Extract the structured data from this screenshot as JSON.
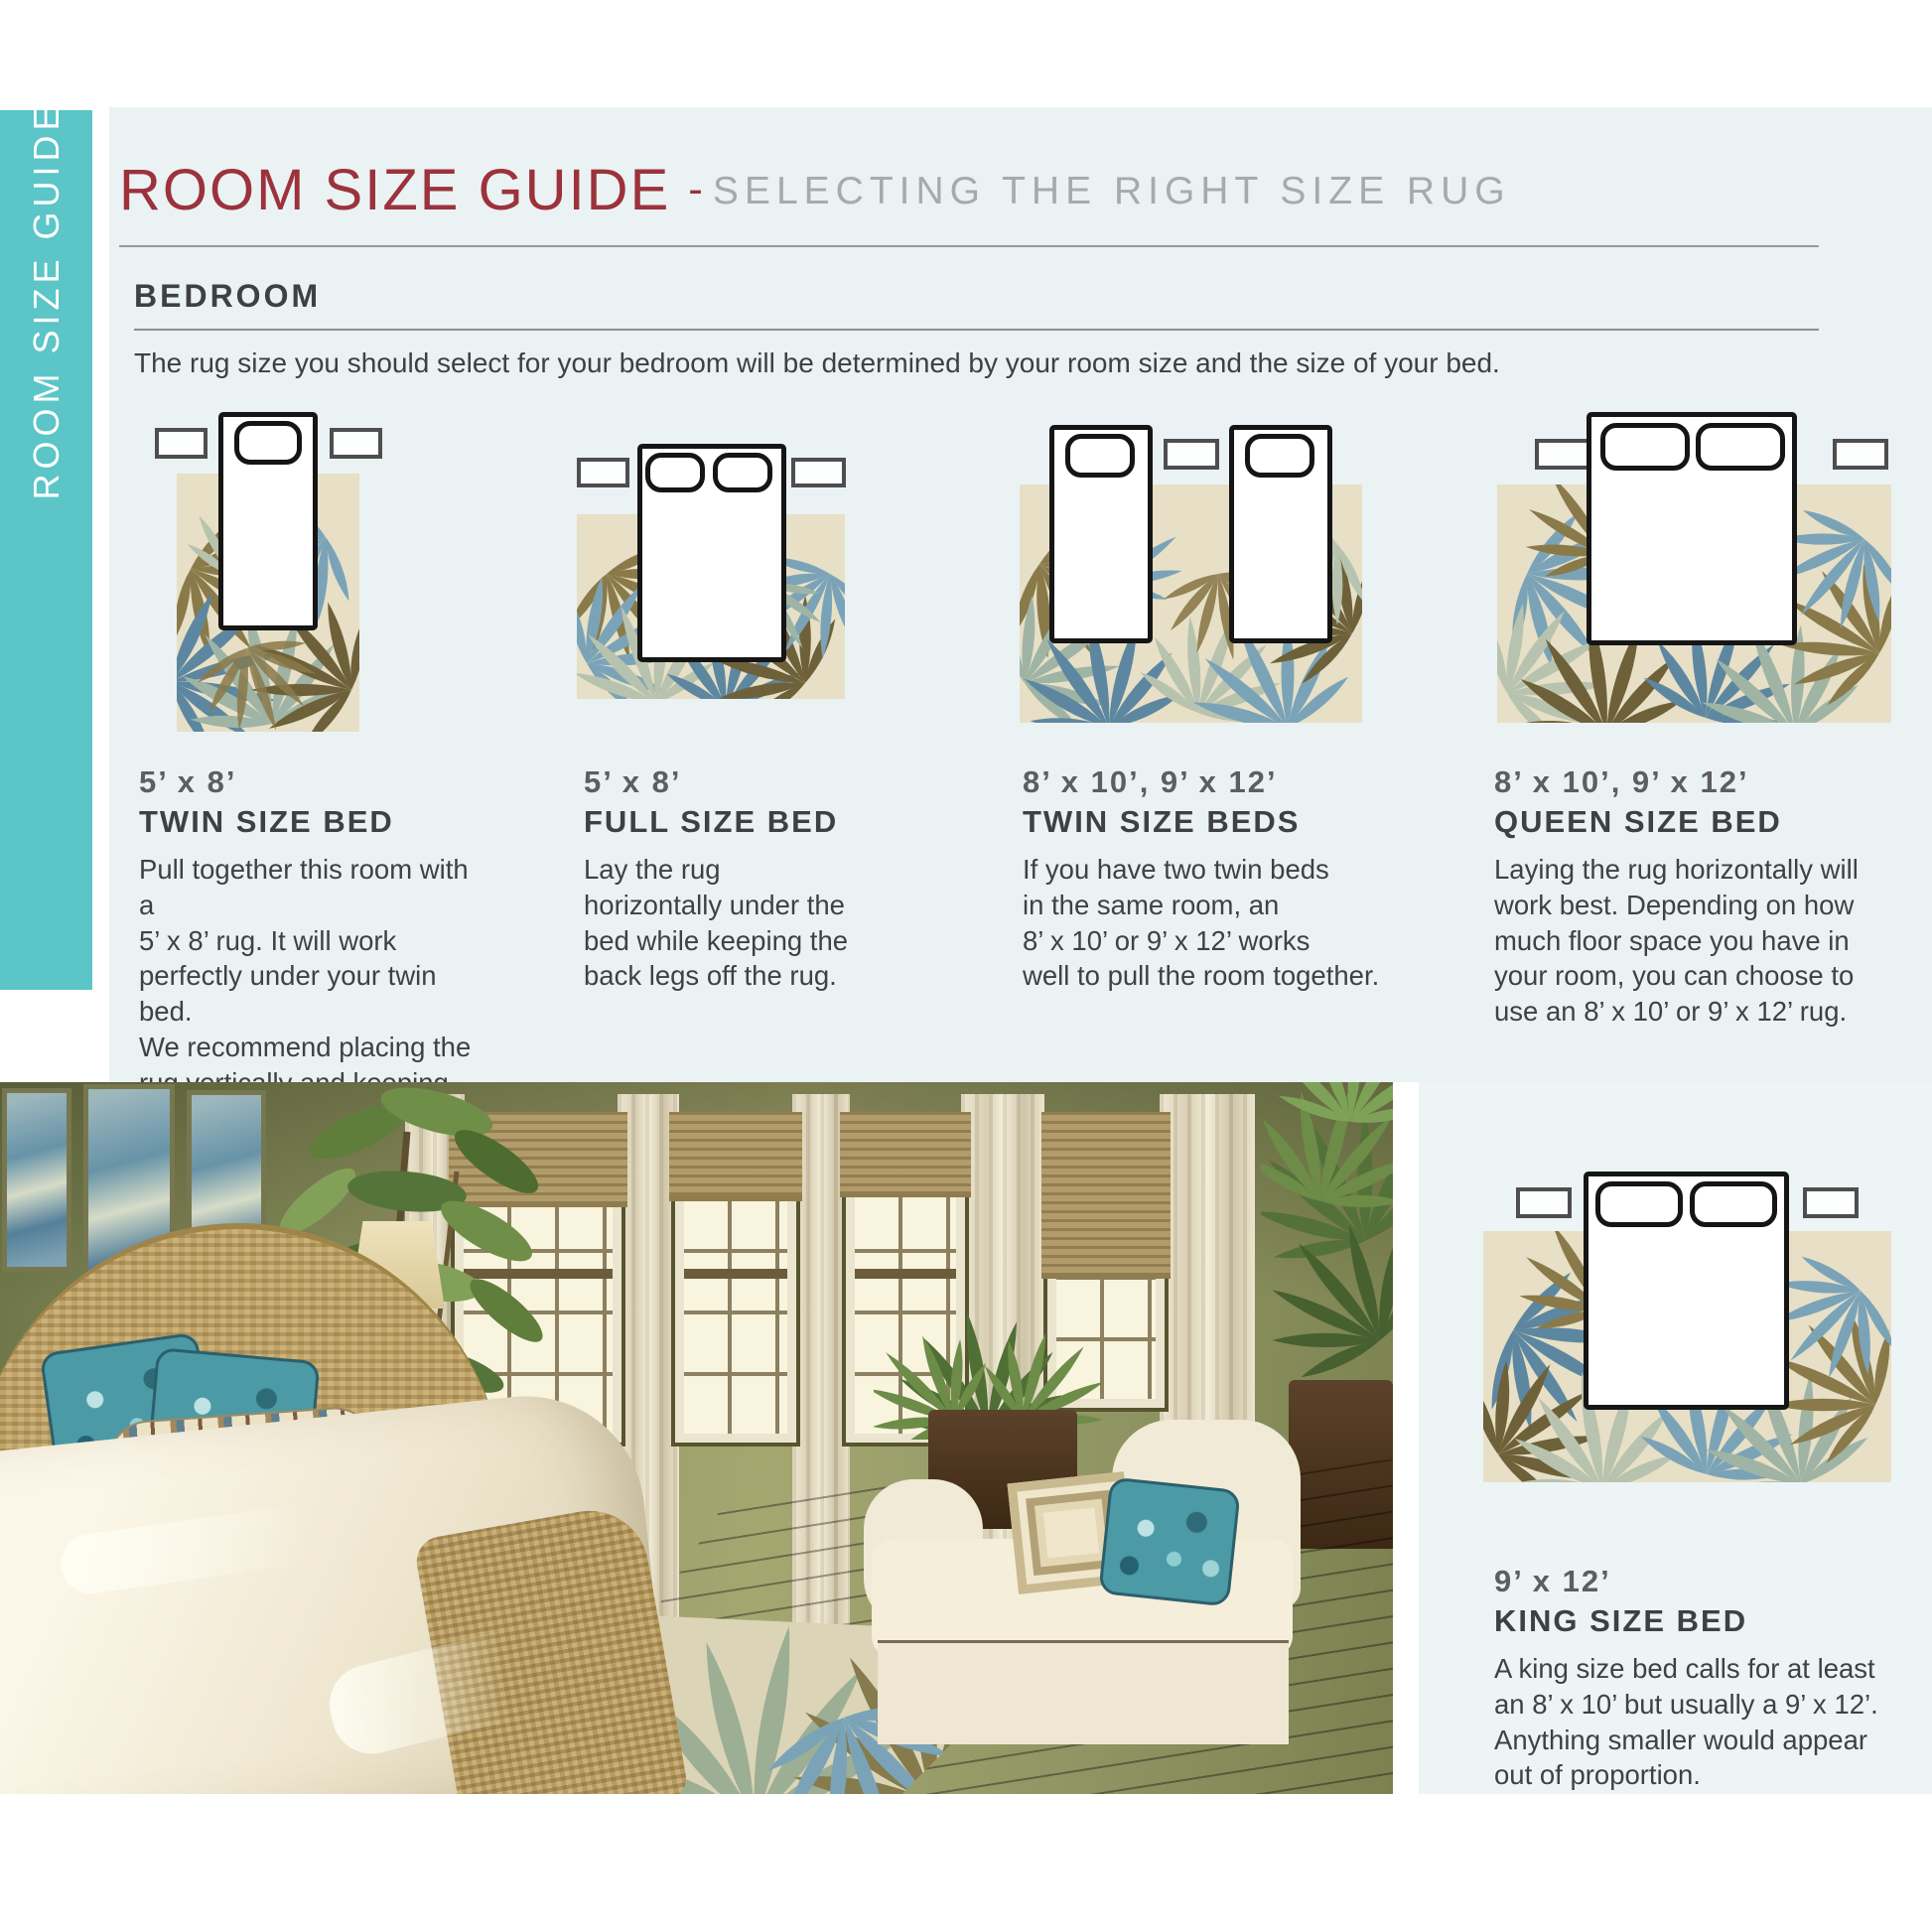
{
  "sidebar": {
    "label": "ROOM SIZE GUIDE"
  },
  "header": {
    "title": "ROOM SIZE GUIDE",
    "separator": "-",
    "subtitle": "SELECTING THE RIGHT SIZE RUG"
  },
  "section": {
    "heading": "BEDROOM",
    "intro": "The rug size you should select for your bedroom will be determined by your room size and the size of your bed."
  },
  "guides": [
    {
      "size": "5’ x 8’",
      "bed": "TWIN SIZE BED",
      "description": "Pull together this room with a\n5’ x 8’ rug. It will work\nperfectly under your twin bed.\nWe recommend placing the\nrug vertically and keeping the\nback legs off the rug."
    },
    {
      "size": "5’ x 8’",
      "bed": "FULL SIZE BED",
      "description": "Lay the rug\nhorizontally under the\nbed while keeping the\nback legs off the rug."
    },
    {
      "size": "8’ x 10’, 9’ x 12’",
      "bed": "TWIN SIZE BEDS",
      "description": "If you have two twin beds\nin the same room, an\n8’ x 10’ or 9’ x 12’ works\nwell to pull the room together."
    },
    {
      "size": "8’ x 10’, 9’ x 12’",
      "bed": "QUEEN SIZE BED",
      "description": "Laying the rug horizontally will\nwork best. Depending on how\nmuch floor space you have in\nyour room, you can choose to\nuse an 8’ x 10’ or 9’ x 12’ rug."
    },
    {
      "size": "9’ x 12’",
      "bed": "KING SIZE BED",
      "description": "A king size bed calls for at least\nan 8’ x 10’ but usually a 9’ x 12’.\nAnything smaller would appear\nout of proportion."
    }
  ],
  "colors": {
    "accent_teal": "#5bc5c7",
    "title_maroon": "#9c323b",
    "subtitle_gray": "#a7aaac",
    "text_dark": "#3f4144",
    "size_gray": "#5c5e60",
    "panel_blue": "#ebf2f4",
    "rug_cream": "#e7e0c6",
    "leaf_blue": "#7ba3b8",
    "leaf_olive": "#8a7a4a",
    "leaf_sage": "#b7c3ae",
    "bed_outline": "#151515"
  }
}
